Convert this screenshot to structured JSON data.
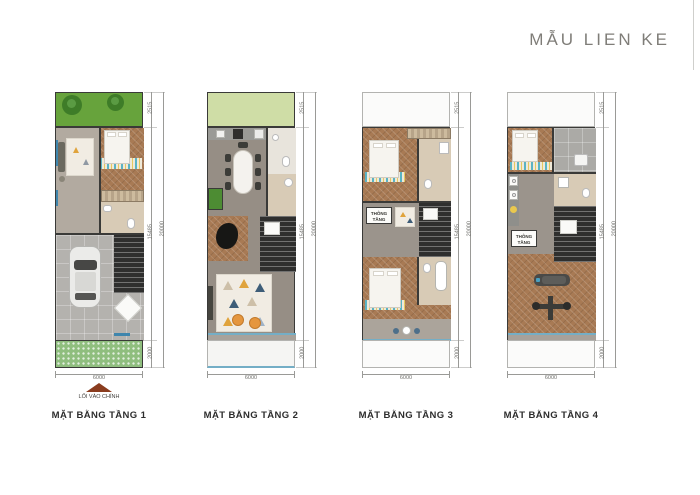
{
  "title": "MẪU LIEN KE",
  "plans": [
    {
      "label": "MẶT BẰNG TẦNG 1",
      "dim_top": "2515",
      "dim_mid": "15485",
      "dim_bottom": "2000",
      "dim_total": "20000",
      "dim_width": "6000",
      "entrance_label": "LỐI VÀO CHÍNH",
      "elements": [
        "garden-trees",
        "living-sofa",
        "bed",
        "wardrobe",
        "bathroom",
        "stairs",
        "car",
        "grass-pavers"
      ]
    },
    {
      "label": "MẶT BẰNG TẦNG 2",
      "dim_top": "2515",
      "dim_mid": "15485",
      "dim_bottom": "2000",
      "dim_total": "20000",
      "dim_width": "6000",
      "elements": [
        "kitchen-counter",
        "dining-table",
        "bathroom",
        "planter",
        "grand-piano",
        "stairs",
        "living-rug",
        "armchairs",
        "balcony"
      ]
    },
    {
      "label": "MẶT BẰNG TẦNG 3",
      "dim_top": "2515",
      "dim_mid": "15485",
      "dim_bottom": "2000",
      "dim_total": "20000",
      "dim_width": "6000",
      "void_label": "THÔNG TẦNG",
      "elements": [
        "bedroom-1",
        "wardrobe",
        "bathroom",
        "stairs",
        "bedroom-2",
        "bathtub",
        "balcony-table"
      ]
    },
    {
      "label": "MẶT BẰNG TẦNG 4",
      "dim_top": "2515",
      "dim_mid": "15485",
      "dim_bottom": "2000",
      "dim_total": "20000",
      "dim_width": "6000",
      "void_label": "THÔNG TẦNG",
      "elements": [
        "bedroom",
        "terrace",
        "bathroom",
        "laundry-machines",
        "stairs",
        "gym-treadmill",
        "gym-bench",
        "balcony"
      ]
    }
  ],
  "colors": {
    "page_bg": "#ffffff",
    "title_text": "#7f7d78",
    "label_text": "#2d2d2d",
    "dim_line": "#9a9a97",
    "dim_text": "#6e6e6a",
    "wall_dark": "#3a3a38",
    "window_blue": "#3f86ad",
    "garden_green": "#67a33c",
    "tree_green": "#3e7c28",
    "lawn_light": "#cfdda6",
    "paver_green": "#8fbe7e",
    "wood_gray": "#b2aaa0",
    "wood_gray2": "#968e85",
    "wood_brown": "#a87a54",
    "garage_gray": "#b4b2ae",
    "bath_beige": "#d8cbb6",
    "stair_dark": "#2f2f2e",
    "chair_orange": "#e5963e",
    "balcony_blue": "#74aec6",
    "open_border": "#b3b3b0"
  }
}
